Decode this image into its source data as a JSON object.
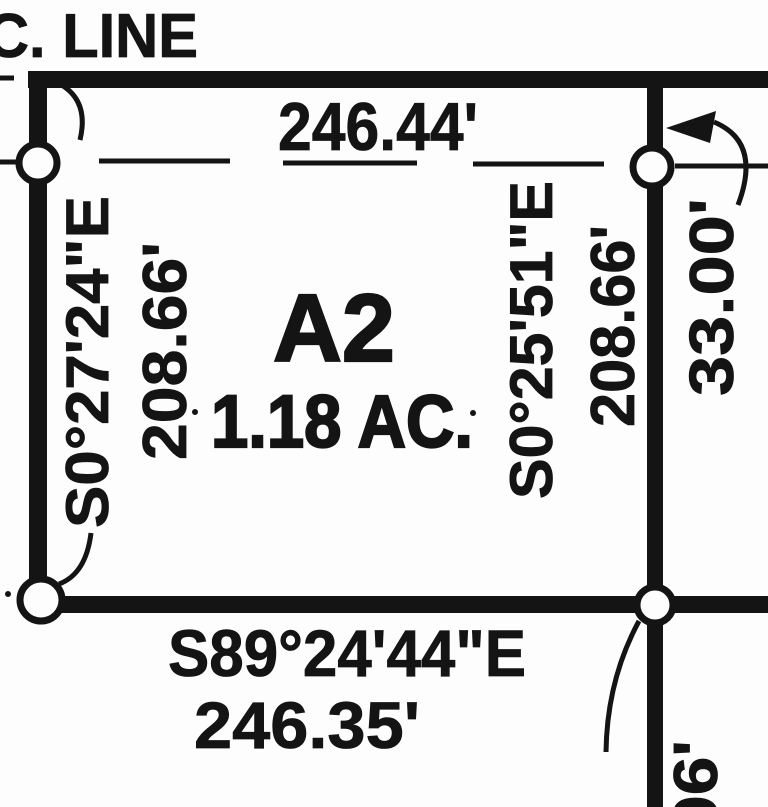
{
  "canvas": {
    "background": "#fdfdfd",
    "ink": "#141414"
  },
  "plat": {
    "section_line_label": "C. LINE",
    "parcel": {
      "id": "A2",
      "area": "1.18 AC."
    },
    "north_boundary": {
      "distance": "246.44'"
    },
    "west_boundary": {
      "bearing": "S0°27'24\"E",
      "distance": "208.66'"
    },
    "east_boundary": {
      "bearing": "S0°25'51\"E",
      "distance": "208.66'"
    },
    "south_boundary": {
      "bearing": "S89°24'44\"E",
      "distance": "246.35'"
    },
    "right_of_way_width": "33.00'",
    "clipped_dimension": "06'"
  }
}
